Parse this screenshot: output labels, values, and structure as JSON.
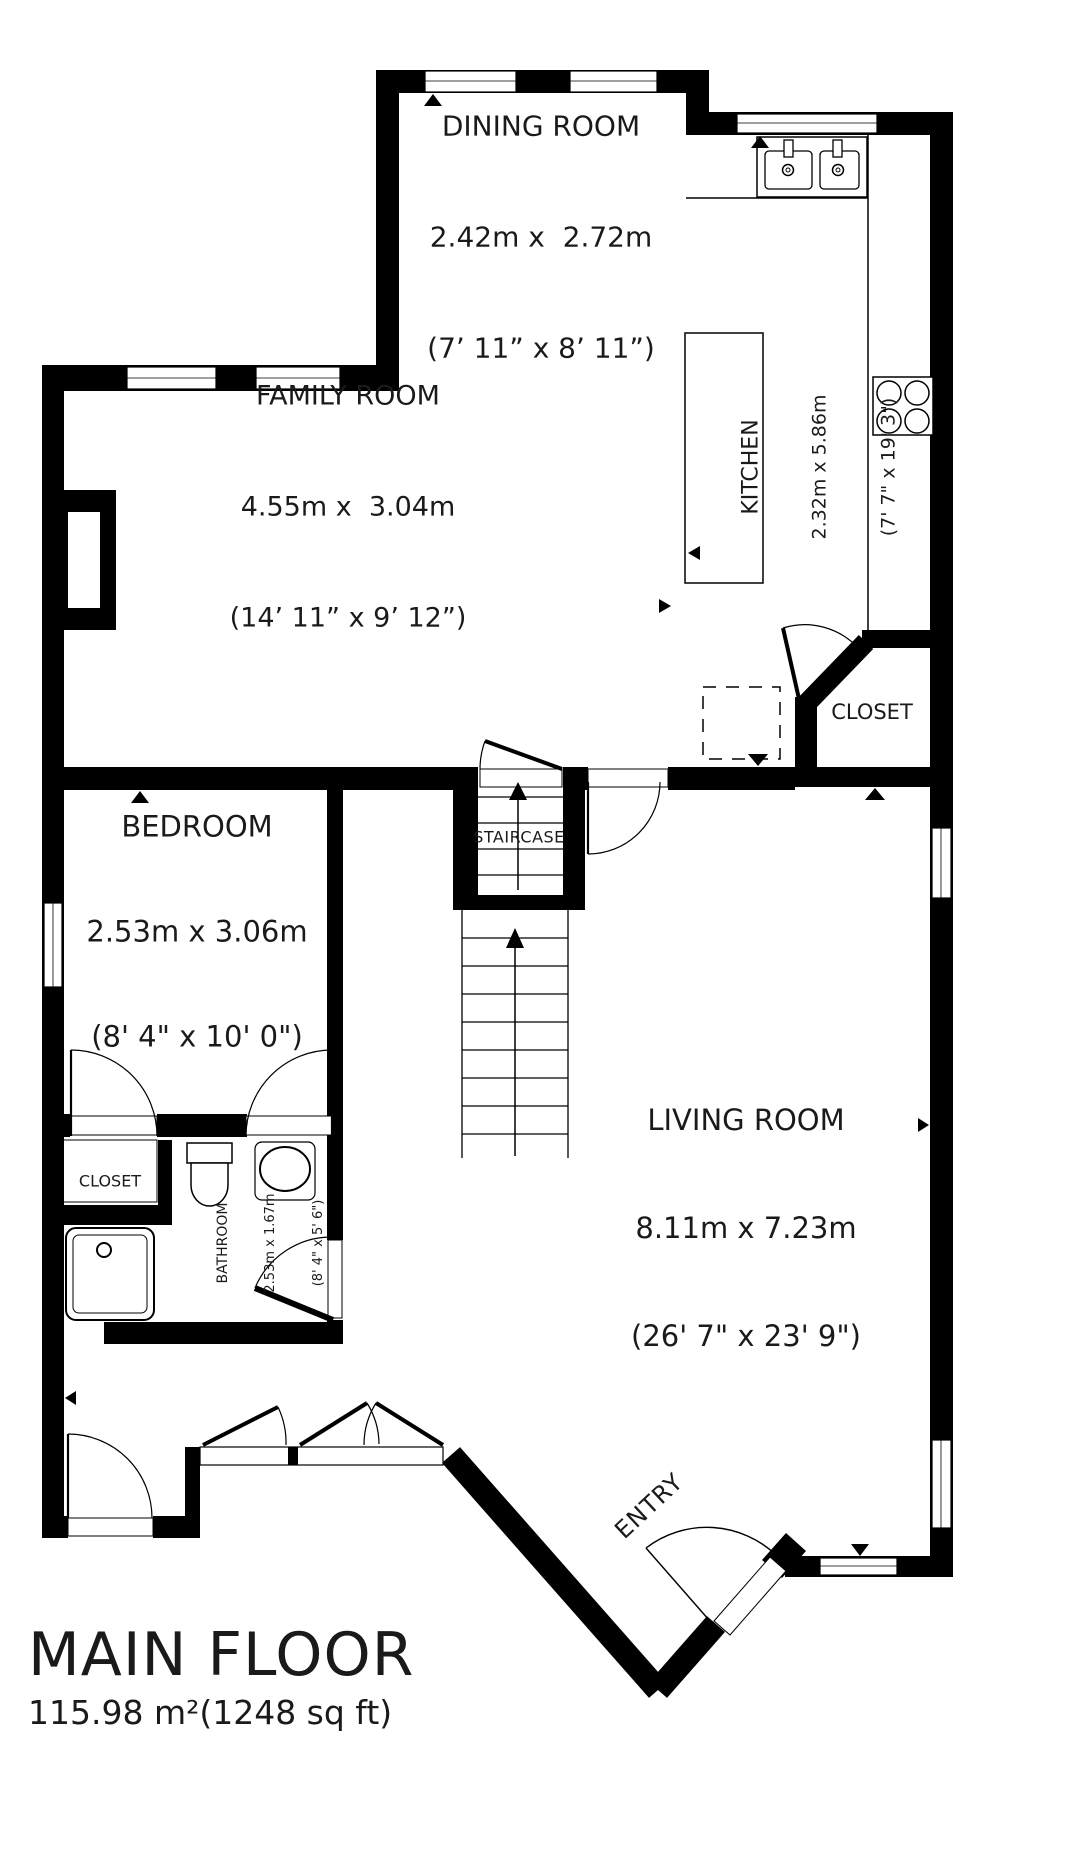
{
  "floor_title": {
    "name": "MAIN FLOOR",
    "area": "115.98 m²(1248 sq ft)"
  },
  "rooms": {
    "dining": {
      "name": "DINING ROOM",
      "metric": "2.42m x  2.72m",
      "imperial": "(7’ 11” x 8’ 11”)"
    },
    "family": {
      "name": "FAMILY ROOM",
      "metric": "4.55m x  3.04m",
      "imperial": "(14’ 11” x 9’ 12”)"
    },
    "kitchen": {
      "name": "KITCHEN",
      "metric": "2.32m x 5.86m",
      "imperial": "(7' 7\" x 19' 3\")"
    },
    "bedroom": {
      "name": "BEDROOM",
      "metric": "2.53m x 3.06m",
      "imperial": "(8' 4\" x 10' 0\")"
    },
    "living": {
      "name": "LIVING ROOM",
      "metric": "8.11m x 7.23m",
      "imperial": "(26' 7\" x 23' 9\")"
    },
    "bathroom": {
      "name": "BATHROOM",
      "metric": "2.53m x 1.67m",
      "imperial": "(8' 4\" x 5' 6\")"
    }
  },
  "labels": {
    "closet_upper": "CLOSET",
    "closet_bedroom": "CLOSET",
    "staircase": "STAIRCASE",
    "entry": "ENTRY"
  },
  "fixtures": {
    "kitchen_sink": "double-basin-sink-icon",
    "stove": "four-burner-stove-icon",
    "kitchen_island": "kitchen-island",
    "refrigerator": "dashed-appliance-outline",
    "toilet": "toilet-icon",
    "bathroom_sink": "oval-sink-icon",
    "shower": "shower-pan-icon",
    "fireplace": "fireplace-niche"
  },
  "colors": {
    "wall": "#000000",
    "background": "#ffffff",
    "text": "#1a1a1a"
  }
}
